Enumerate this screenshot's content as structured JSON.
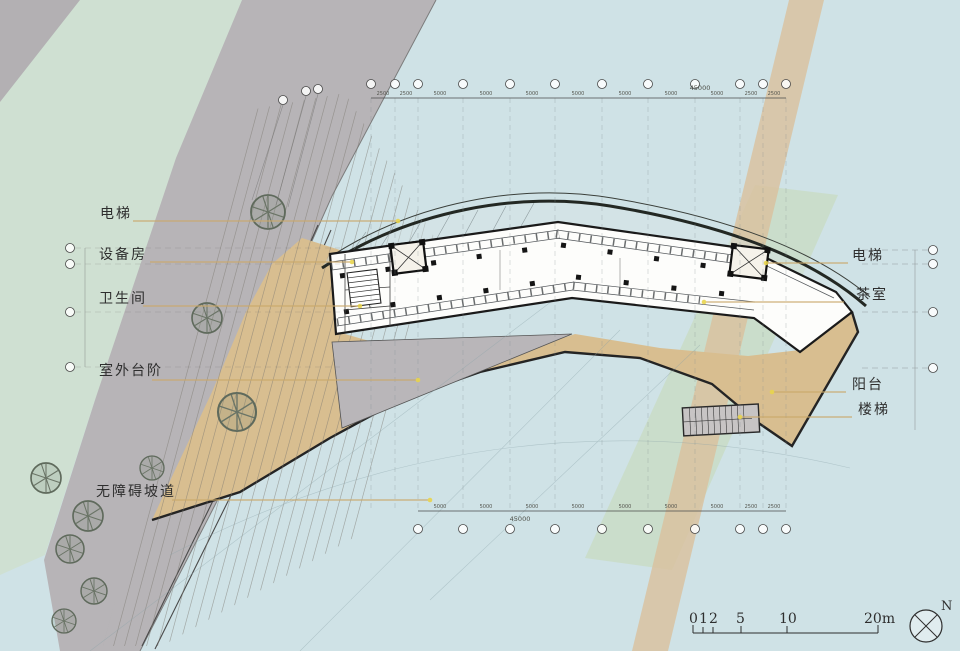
{
  "drawing": {
    "type": "architectural-floor-plan",
    "callouts_left": [
      {
        "label": "电梯"
      },
      {
        "label": "设备房"
      },
      {
        "label": "卫生间"
      },
      {
        "label": "室外台阶"
      },
      {
        "label": "无障碍坡道"
      }
    ],
    "callouts_right": [
      {
        "label": "电梯"
      },
      {
        "label": "茶室"
      },
      {
        "label": "阳台"
      },
      {
        "label": "楼梯"
      }
    ]
  },
  "dimensions": {
    "top_total": "45000",
    "top_segments": [
      "2500",
      "2500",
      "5000",
      "5000",
      "5000",
      "5000",
      "5000",
      "5000",
      "5000",
      "2500",
      "2500"
    ],
    "bottom_total": "45000",
    "bottom_segments": [
      "5000",
      "5000",
      "5000",
      "5000",
      "5000",
      "5000",
      "5000",
      "2500",
      "2500"
    ]
  },
  "scale_bar": {
    "ticks": [
      "0",
      "1",
      "2",
      "5",
      "10",
      "20m"
    ]
  },
  "north_label": "N",
  "colors": {
    "water": "#cfe2e6",
    "vegetation": "#cfe0d2",
    "terrain_gray": "#b7b4b7",
    "deck_tan": "#d8be90",
    "road_strip": "#d9c19c",
    "overlay_green": "#c6d8b4",
    "leader_khaki": "#c9a96b",
    "ink": "#1a1a1a"
  }
}
